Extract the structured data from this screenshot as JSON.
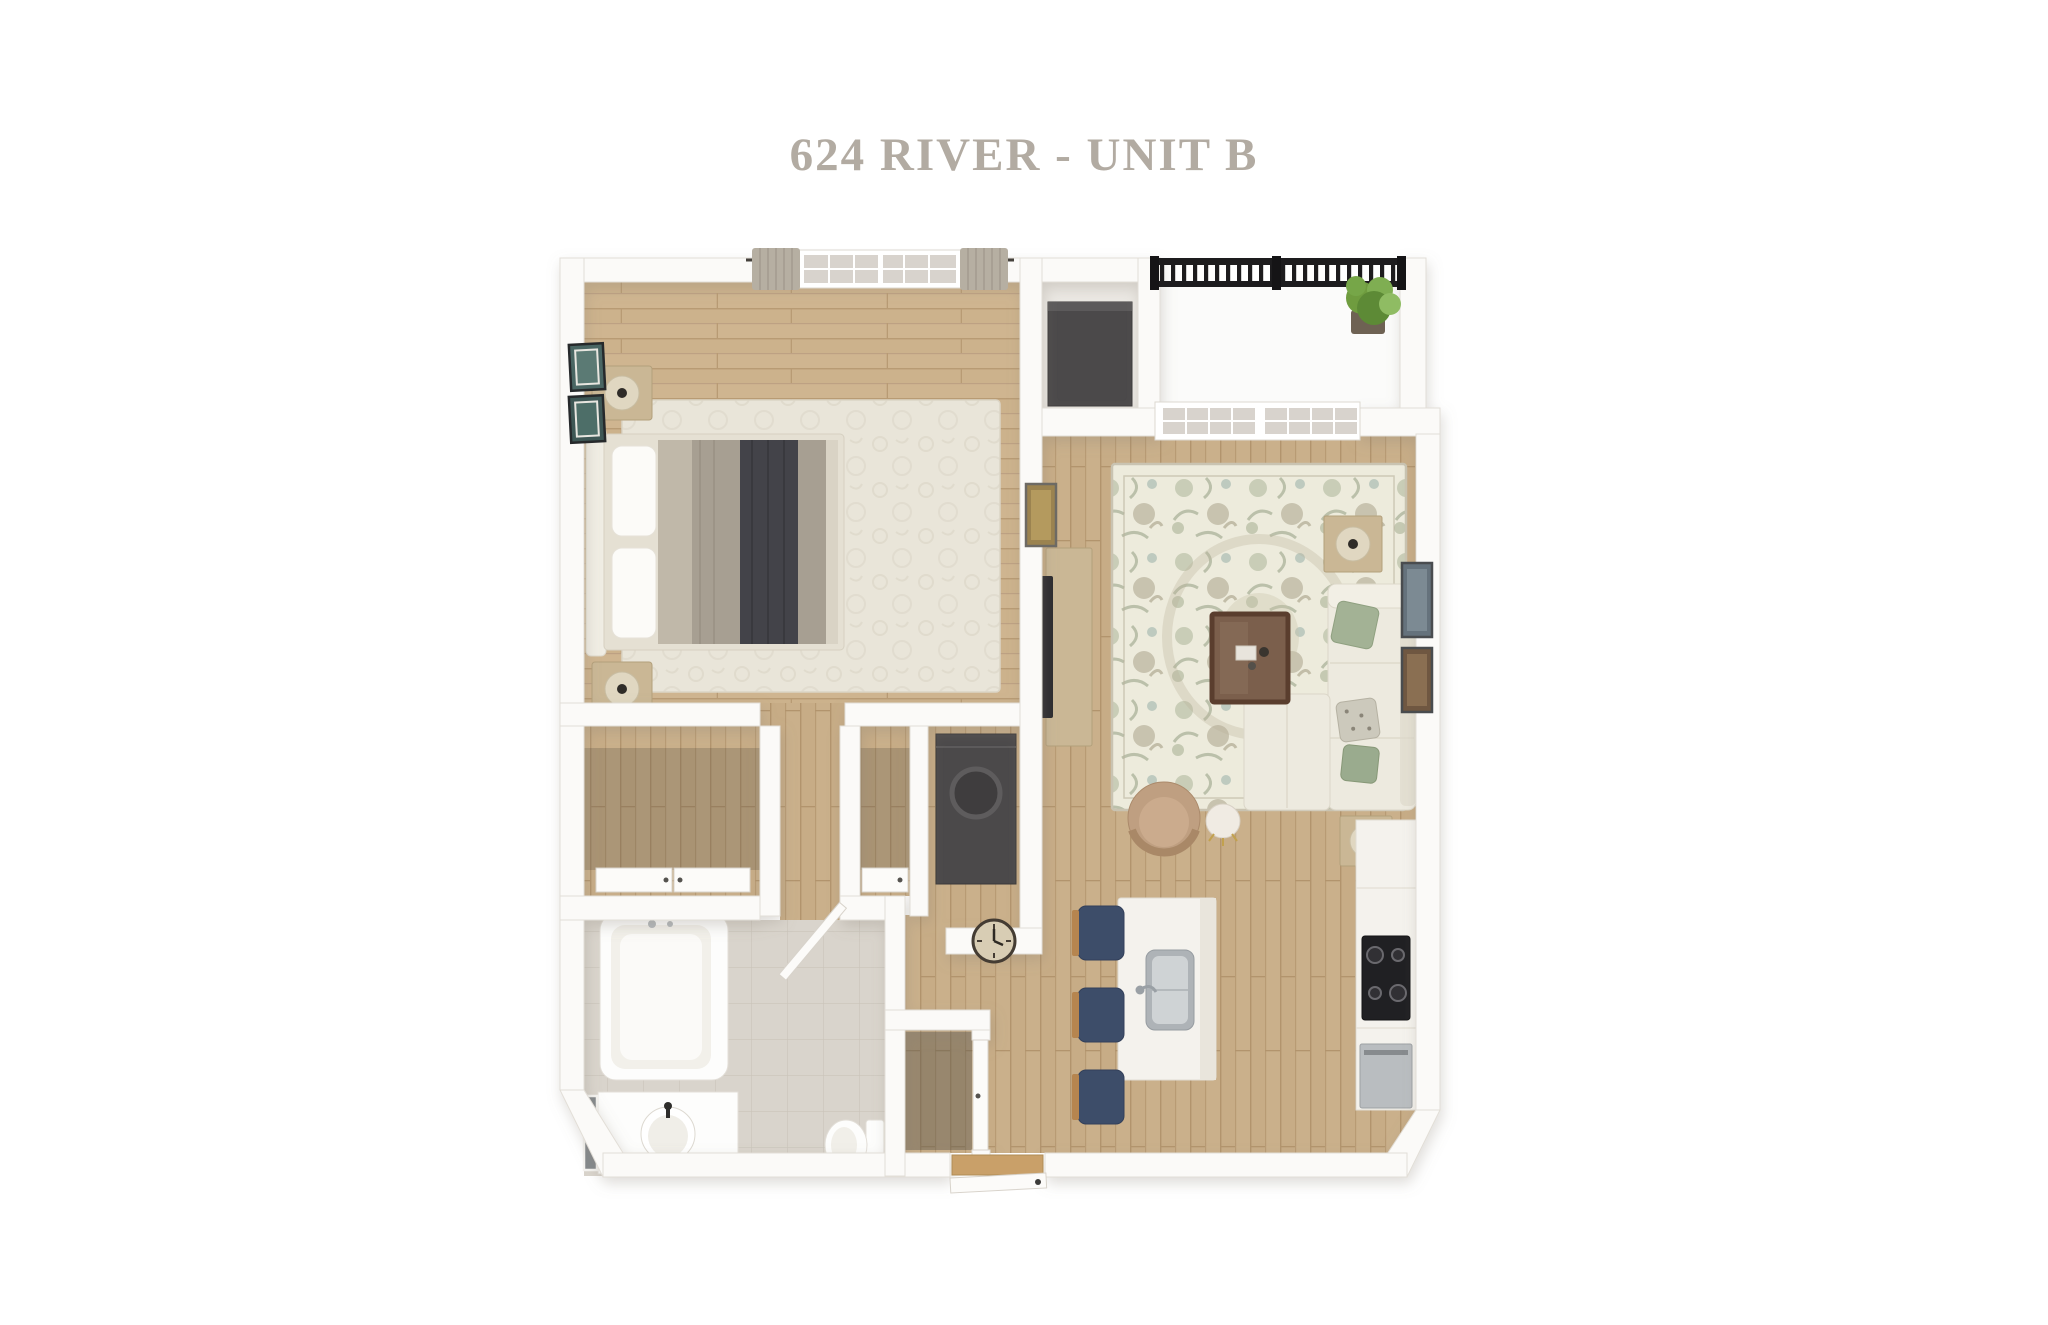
{
  "title": {
    "text": "624 RIVER - UNIT B"
  },
  "floorplan": {
    "type": "3d-floor-plan-render",
    "rooms": [
      {
        "name": "bedroom"
      },
      {
        "name": "living-room"
      },
      {
        "name": "kitchen"
      },
      {
        "name": "bathroom"
      },
      {
        "name": "balcony"
      },
      {
        "name": "laundry-closet"
      },
      {
        "name": "storage-niche"
      },
      {
        "name": "closet-a"
      },
      {
        "name": "closet-b"
      },
      {
        "name": "entry-closet"
      },
      {
        "name": "entry"
      }
    ],
    "furniture": {
      "bedroom": [
        "bed",
        "headboard",
        "pillows",
        "blanket",
        "throw-blanket",
        "nightstand",
        "nightstand",
        "table-lamp",
        "table-lamp",
        "area-rug",
        "window",
        "curtains",
        "wall-art",
        "wall-art"
      ],
      "living_room": [
        "sectional-sofa",
        "chaise",
        "green-pillow",
        "patterned-pillow",
        "sage-pillow",
        "coffee-table",
        "accent-chair",
        "round-side-stool",
        "side-table-with-lamp",
        "side-table-with-lamp",
        "media-console",
        "tv",
        "floral-rug",
        "french-window",
        "wall-art",
        "wall-art",
        "wall-art"
      ],
      "kitchen": [
        "island",
        "island-sink",
        "faucet",
        "bar-stool",
        "bar-stool",
        "bar-stool",
        "counter",
        "cooktop",
        "dishwasher"
      ],
      "bathroom": [
        "bathtub",
        "tub-faucet",
        "vanity",
        "sink",
        "sink-faucet",
        "mirror",
        "toilet",
        "door"
      ],
      "laundry_closet": [
        "washer-dryer"
      ],
      "storage_niche": [
        "storage-unit"
      ],
      "balcony": [
        "railing",
        "potted-plant"
      ],
      "entry": [
        "entry-door",
        "threshold",
        "closet-door"
      ],
      "closets": [
        "closet-door",
        "closet-door",
        "wall-clock"
      ]
    },
    "colors": {
      "background": "#ffffff",
      "title_text": "#b2aba2",
      "walls": "#fbfaf8",
      "wood_floor": "#c7ac86",
      "bedroom_rug": "#e9e5d9",
      "living_rug_base": "#edebdc",
      "living_rug_sage": "#aab396",
      "tile_floor": "#d9d4cc",
      "sofa_cream": "#edeadf",
      "pillow_green": "#a3b295",
      "stool_navy": "#3d4d69",
      "railing_black": "#1d1c1e",
      "plant_green": "#7fae52",
      "appliance_dark": "#4b494a",
      "furniture_wood": "#cab795",
      "blanket_gray": "#a79f92",
      "throw_charcoal": "#434349"
    }
  }
}
